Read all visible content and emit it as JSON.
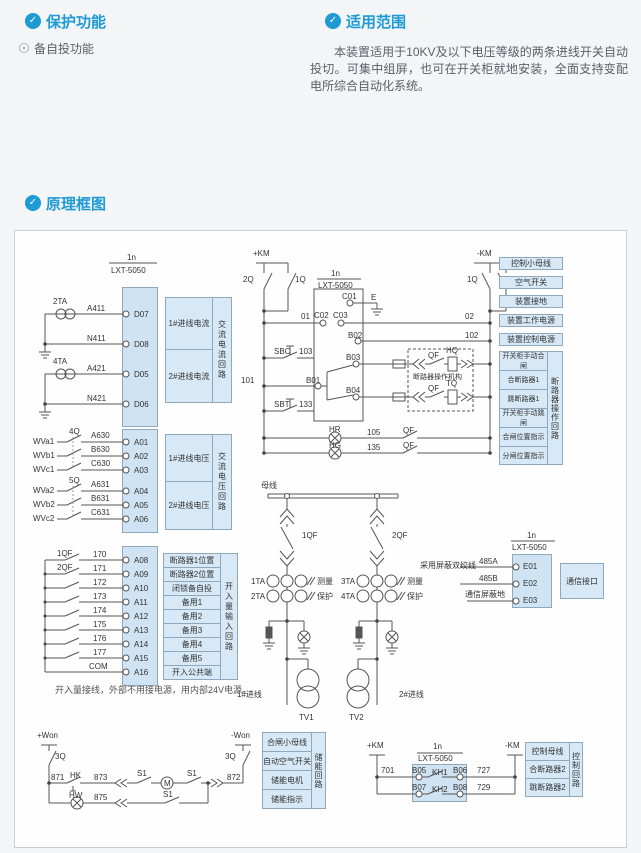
{
  "colors": {
    "accent": "#1e9ad5",
    "box_fill": "#d7e9f6",
    "strip_fill": "#cfe3f2",
    "line": "#555555"
  },
  "icons": {
    "section": "shield-check-icon",
    "bullet": "double-circle-icon"
  },
  "header": {
    "protection": {
      "title": "保护功能",
      "bullet_item": "备自投功能"
    },
    "scope": {
      "title": "适用范围",
      "body": "本装置适用于10KV及以下电压等级的两条进线开关自动投切。可集中组屏，也可在开关柜就地安装，全面支持变配电所综合自动化系统。"
    },
    "diagram_title": "原理框图"
  },
  "diagram": {
    "device_label": {
      "top": "1n",
      "model": "LXT-5050"
    },
    "current": {
      "ct1": "2TA",
      "ct2": "4TA",
      "wires": [
        "A411",
        "N411",
        "A421",
        "N421"
      ],
      "terminals": [
        "D07",
        "D08",
        "D05",
        "D06"
      ],
      "boxes": [
        "1#进线电流",
        "2#进线电流"
      ],
      "vertical": "交流电流回路"
    },
    "voltage": {
      "inputs": [
        "WVa1",
        "WVb1",
        "WVc1",
        "WVa2",
        "WVb2",
        "WVc2"
      ],
      "switch1": "4Q",
      "switch2": "5Q",
      "wires": [
        "A630",
        "B630",
        "C630",
        "A631",
        "B631",
        "C631"
      ],
      "terminals": [
        "A01",
        "A02",
        "A03",
        "A04",
        "A05",
        "A06"
      ],
      "boxes": [
        "1#进线电压",
        "2#进线电压"
      ],
      "vertical": "交流电压回路"
    },
    "digital": {
      "contact1": "1QF",
      "contact2": "2QF",
      "wires": [
        "170",
        "171",
        "172",
        "173",
        "174",
        "175",
        "176",
        "177",
        "COM"
      ],
      "terminals": [
        "A08",
        "A09",
        "A10",
        "A11",
        "A12",
        "A13",
        "A14",
        "A15",
        "A16"
      ],
      "boxes": [
        "断路器1位置",
        "断路器2位置",
        "闭锁备自投",
        "备用1",
        "备用2",
        "备用3",
        "备用4",
        "备用5",
        "开入公共端"
      ],
      "vertical": "开入量输入回路",
      "note": "开入量接线，外部不用接电源，用内部24V电源。"
    },
    "control1": {
      "bus_pos": "+KM",
      "bus_neg": "-KM",
      "sw_l1": "2Q",
      "sw_l2": "1Q",
      "sw_r1": "1Q",
      "sw_r2": "2Q",
      "w01": "01",
      "w02": "02",
      "w102": "102",
      "w103": "103",
      "w101": "101",
      "w133": "133",
      "w105": "105",
      "w135": "135",
      "c01": "C01",
      "c02": "C02",
      "c03": "C03",
      "b01": "B01",
      "b02": "B02",
      "b03": "B03",
      "b04": "B04",
      "ground": "E",
      "sbc": "SBC",
      "sbt": "SBT",
      "hr": "HR",
      "hg": "HG",
      "qf": "QF",
      "hq": "HQ",
      "tq": "TQ",
      "mech": "断路器操作机构",
      "right_boxes": [
        "控制小母线",
        "空气开关",
        "装置接地",
        "装置工作电源",
        "装置控制电源"
      ],
      "op_boxes": [
        "开关柜手动合闸",
        "合断路器1",
        "跳断路器1",
        "开关柜手动跳闸",
        "合闸位置指示",
        "分闸位置指示"
      ],
      "op_vertical": "断路器操作回路"
    },
    "primary": {
      "busbar": "母线",
      "qf1": "1QF",
      "qf2": "2QF",
      "ta1": "1TA",
      "ta2": "2TA",
      "ta3": "3TA",
      "ta4": "4TA",
      "measure": "测量",
      "protect": "保护",
      "tv1": "TV1",
      "tv2": "TV2",
      "line1": "1#进线",
      "line2": "2#进线",
      "twisted": "采用屏蔽双绞线"
    },
    "comm": {
      "w485a": "485A",
      "w485b": "485B",
      "wshield": "通信屏蔽地",
      "terminals": [
        "E01",
        "E02",
        "E03"
      ],
      "box": "通信接口"
    },
    "storage": {
      "bus_pos": "+Won",
      "bus_neg": "-Won",
      "sw": "3Q",
      "w871": "871",
      "hk": "HK",
      "w873": "873",
      "s1": "S1",
      "motor": "M",
      "w872": "872",
      "hw": "HW",
      "w875": "875",
      "boxes": [
        "合闸小母线",
        "自动空气开关",
        "储能电机",
        "储能指示"
      ],
      "vertical": "储能回路"
    },
    "control2": {
      "bus_pos": "+KM",
      "bus_neg": "-KM",
      "w701": "701",
      "w727": "727",
      "w729": "729",
      "b05": "B05",
      "b06": "B06",
      "b07": "B07",
      "b08": "B08",
      "kh1": "KH1",
      "kh2": "KH2",
      "boxes": [
        "控制母线",
        "合断路器2",
        "跳断路器2"
      ],
      "vertical": "控制回路"
    }
  }
}
